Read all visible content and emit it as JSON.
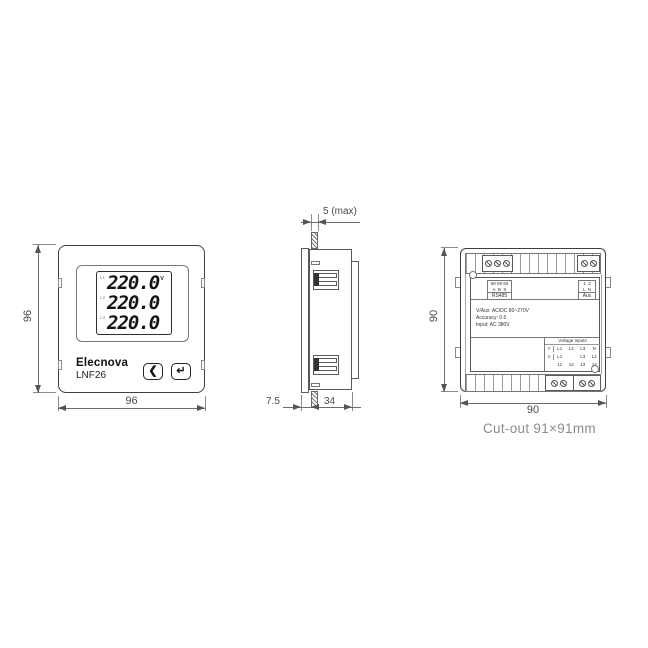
{
  "front_view": {
    "brand": "Elecnova",
    "model": "LNF26",
    "display_rows": [
      {
        "phase": "L1",
        "value": "220.0",
        "unit": "V"
      },
      {
        "phase": "L2",
        "value": "220.0",
        "unit": ""
      },
      {
        "phase": "L3",
        "value": "220.0",
        "unit": ""
      }
    ],
    "buttons": {
      "back_glyph": "❮",
      "enter_glyph": "↵"
    },
    "dim_height": "96",
    "dim_width": "96"
  },
  "side_view": {
    "dim_panel_thickness": "5 (max)",
    "dim_bezel_depth": "7.5",
    "dim_body_depth": "34"
  },
  "back_view": {
    "dim_height": "90",
    "dim_width": "90",
    "rs485_block": {
      "row1": "58 59 60",
      "row2": "A  B  S",
      "label": "RS485"
    },
    "aux_block": {
      "row1": "1  2",
      "row2": "L  N",
      "label": "Aux"
    },
    "specs": [
      "V/Aux: AC/DC 80~270V",
      "Accuracy: 0.5",
      "Input: AC 380V"
    ],
    "voltage_table": {
      "title": "Voltage Inputs",
      "rows": [
        [
          "Y",
          "L1",
          "L2",
          "L3",
          "N"
        ],
        [
          "V",
          "L1",
          "",
          "L3",
          "L2"
        ],
        [
          "",
          "11",
          "12",
          "13",
          "14"
        ]
      ]
    }
  },
  "footer": {
    "cutout_note": "Cut-out 91×91mm"
  }
}
